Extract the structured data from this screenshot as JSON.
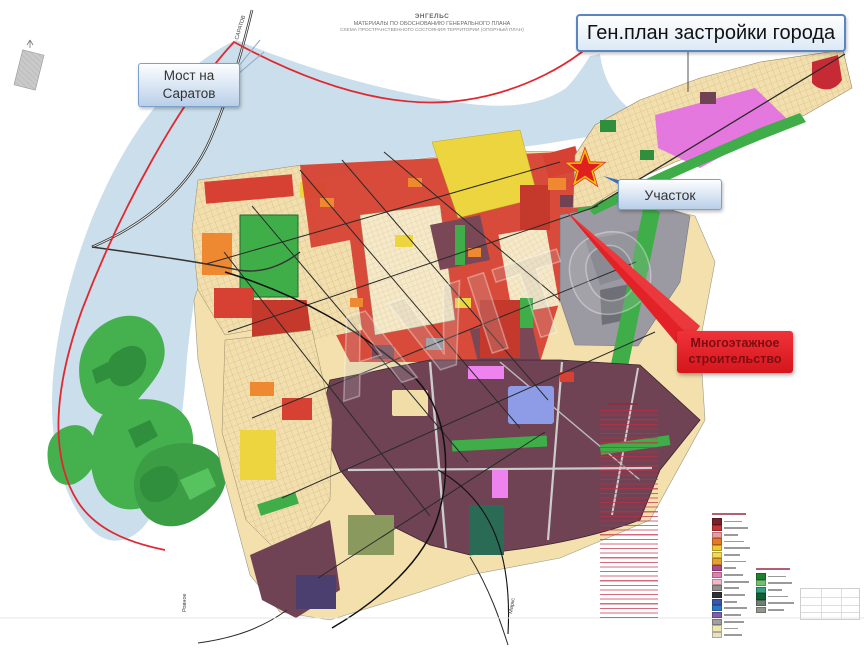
{
  "document": {
    "small_header": {
      "line1": "ЭНГЕЛЬС",
      "line2": "МАТЕРИАЛЫ ПО ОБОСНОВАНИЮ ГЕНЕРАЛЬНОГО ПЛАНА",
      "line3": "СХЕМА ПРОСТРАНСТВЕННОГО СОСТОЯНИЯ ТЕРРИТОРИИ (ОПОРНЫЙ ПЛАН)"
    },
    "title_box_label": "Ген.план застройки  города"
  },
  "callouts": {
    "bridge_line1": "Мост на",
    "bridge_line2": "Саратов",
    "plot_label": "Участок",
    "construction_line1": "Многоэтажное",
    "construction_line2": "строительство"
  },
  "road_labels": {
    "north_road": "САРАТОВ",
    "south_west_road": "Ровное",
    "south_east_road": "Маркс"
  },
  "map": {
    "star_marker": {
      "fill": "#e01f1f",
      "outline": "#f7c600"
    },
    "accent_colors": {
      "territory_border": "#e02830",
      "water": "#cadeeb",
      "greenery": "#3fae49",
      "residential_red": "#d64133",
      "low_rise_tan": "#f2dfae",
      "industrial_plum": "#6f4254",
      "callout_red": "#e8232a",
      "callout_blue_border": "#7ba0cc"
    }
  },
  "legend": {
    "swatches_primary": [
      "#7a1f2b",
      "#c83232",
      "#e89aa6",
      "#e87828",
      "#f0c830",
      "#f0dc50",
      "#e8a030",
      "#b04890",
      "#e080b0",
      "#f0b8c8",
      "#909090",
      "#303030",
      "#3858b0",
      "#2878c8",
      "#8060a8",
      "#a0a0a0",
      "#f0e8b0",
      "#e8e0c8"
    ],
    "swatches_secondary": [
      "#208030",
      "#70c070",
      "#30a080",
      "#106030",
      "#6e8070",
      "#909890"
    ]
  }
}
